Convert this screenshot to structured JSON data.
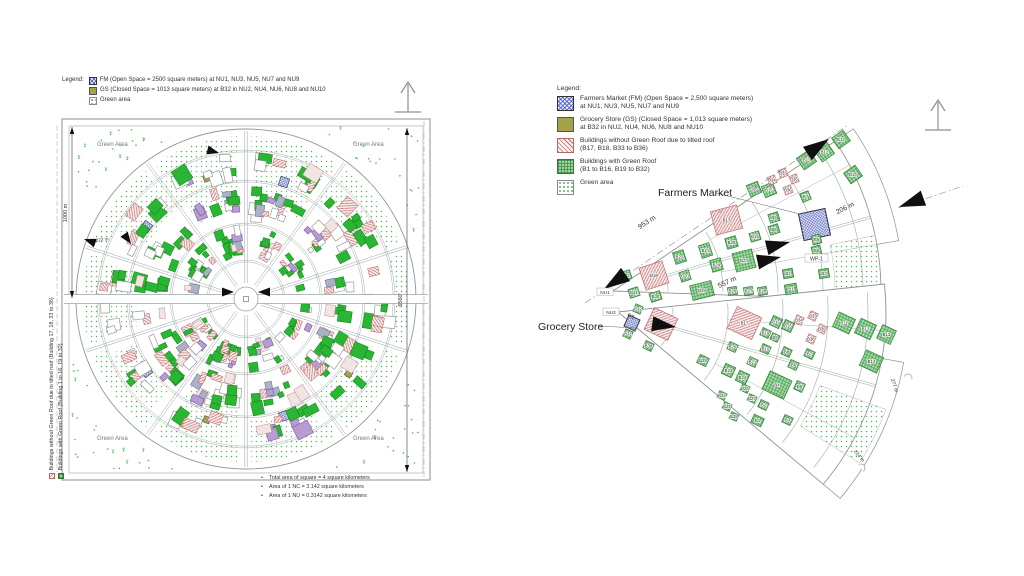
{
  "colors": {
    "road": "#9aa3a3",
    "frame": "#8f8f8f",
    "text": "#3c3c3c",
    "green_roof_fill": "#2ab535",
    "green_grid_fill": "#a9dcab",
    "green_grid_line": "#2e8b3a",
    "no_green_fill": "#f8ecec",
    "no_green_line": "#bf6868",
    "fm_fill": "#eef0fb",
    "fm_line": "#5f6dbf",
    "gs_fill": "#a6a24c",
    "purple_fill": "#b79bd4",
    "slate_fill": "#aab1c9",
    "green_dot": "#55b45c",
    "arrow_black": "#101010",
    "dim_line": "#9a9a9a"
  },
  "left_diagram": {
    "legend_title": "Legend:",
    "legend_items": [
      {
        "swatch": "fm",
        "label": "FM (Open Space = 2500 square meters) at NU1, NU3, NU5, NU7 and NU9"
      },
      {
        "swatch": "gs",
        "label": "GS (Closed Space = 1013 square meters) at B32 in NU2, NU4, NU6, NU8 and NU10"
      },
      {
        "swatch": "green-dots",
        "label": "Green area"
      }
    ],
    "side_legend_items": [
      {
        "swatch": "no-green-roof",
        "label": "Buildings without Green Roof due to tilted roof (Building 17, 18, 33 to 36)"
      },
      {
        "swatch": "green-roof",
        "label": "Buildings with Green Roof (Building 1 to 16, 19 to 32)"
      }
    ],
    "corner_label": "Green Area",
    "dim_left": "1000 m",
    "dim_right": "6560'",
    "dim_inner": "222 m",
    "notes": [
      "Total area of square = 4 square kilometers",
      "Area of 1 NC = 3.142 square kilometers",
      "Area of 1 NU = 0.3142 square kilometers"
    ]
  },
  "right_diagram": {
    "legend_title": "Legend:",
    "legend_items": [
      {
        "swatch": "fm",
        "lines": [
          "Farmers Market (FM) (Open Space = 2,500 square meters)",
          "at NU1, NU3, NU5, NU7 and NU9"
        ]
      },
      {
        "swatch": "gs",
        "lines": [
          "Grocery Store (GS) (Closed Space = 1,013 square meters)",
          "at B32 in NU2, NU4, NU6, NU8 and NU10"
        ]
      },
      {
        "swatch": "no-green-roof",
        "lines": [
          "Buildings without Green Roof due to tilted roof",
          "(B17, B18, B33 to B36)"
        ]
      },
      {
        "swatch": "green-roof",
        "lines": [
          "Buildings with Green Roof",
          "(B1 to B16, B19 to B32)"
        ]
      },
      {
        "swatch": "green-dots",
        "lines": [
          "Green area"
        ]
      }
    ],
    "callout_farmers_market": "Farmers Market",
    "callout_grocery_store": "Grocery Store",
    "label_wp1": "WP-1",
    "label_nu1": "NU1",
    "label_nu2": "NU2",
    "label_gs": "GS",
    "dimensions": [
      {
        "text": "953 m",
        "x": 648,
        "y": 224,
        "rot": -33,
        "fs": 7
      },
      {
        "text": "206 m",
        "x": 846,
        "y": 210,
        "rot": -27,
        "fs": 7
      },
      {
        "text": "557 m",
        "x": 728,
        "y": 284,
        "rot": -25,
        "fs": 7
      },
      {
        "text": "277 m",
        "x": 893,
        "y": 386,
        "rot": 72,
        "fs": 5
      },
      {
        "text": "224 m",
        "x": 858,
        "y": 457,
        "rot": 50,
        "fs": 5
      }
    ],
    "buildings": [
      {
        "label": "",
        "type": "fm",
        "x": 801,
        "y": 211,
        "w": 27,
        "h": 27,
        "rot": -12
      },
      {
        "label": "B17",
        "type": "ng",
        "x": 713,
        "y": 208,
        "w": 27,
        "h": 24,
        "rot": -15
      },
      {
        "label": "B18",
        "type": "ng",
        "x": 642,
        "y": 264,
        "w": 24,
        "h": 23,
        "rot": -18
      },
      {
        "label": "B32",
        "type": "g",
        "x": 621,
        "y": 271,
        "w": 10,
        "h": 9,
        "rot": -18
      },
      {
        "label": "B31",
        "type": "g",
        "x": 629,
        "y": 288,
        "w": 10,
        "h": 9,
        "rot": -18
      },
      {
        "label": "B30",
        "type": "g",
        "x": 650,
        "y": 292,
        "w": 11,
        "h": 9,
        "rot": -18
      },
      {
        "label": "B22",
        "type": "g",
        "x": 674,
        "y": 251,
        "w": 11,
        "h": 12,
        "rot": -18
      },
      {
        "label": "B20",
        "type": "g",
        "x": 680,
        "y": 271,
        "w": 10,
        "h": 10,
        "rot": -18
      },
      {
        "label": "B21",
        "type": "g",
        "x": 700,
        "y": 244,
        "w": 11,
        "h": 13,
        "rot": -18
      },
      {
        "label": "B29",
        "type": "g",
        "x": 691,
        "y": 283,
        "w": 22,
        "h": 15,
        "rot": -14
      },
      {
        "label": "B25",
        "type": "g",
        "x": 726,
        "y": 237,
        "w": 11,
        "h": 11,
        "rot": -16
      },
      {
        "label": "B24",
        "type": "g",
        "x": 711,
        "y": 259,
        "w": 11,
        "h": 12,
        "rot": -16
      },
      {
        "label": "B23",
        "type": "g",
        "x": 734,
        "y": 251,
        "w": 20,
        "h": 19,
        "rot": -14
      },
      {
        "label": "B26",
        "type": "g",
        "x": 728,
        "y": 287,
        "w": 9,
        "h": 8,
        "rot": -10
      },
      {
        "label": "B27",
        "type": "g",
        "x": 744,
        "y": 287,
        "w": 9,
        "h": 8,
        "rot": -10
      },
      {
        "label": "B28",
        "type": "g",
        "x": 758,
        "y": 287,
        "w": 9,
        "h": 8,
        "rot": -10
      },
      {
        "label": "B19",
        "type": "g",
        "x": 750,
        "y": 232,
        "w": 10,
        "h": 9,
        "rot": -16
      },
      {
        "label": "B16",
        "type": "g",
        "x": 748,
        "y": 183,
        "w": 12,
        "h": 12,
        "rot": -22
      },
      {
        "label": "B15",
        "type": "g",
        "x": 763,
        "y": 184,
        "w": 12,
        "h": 12,
        "rot": -22
      },
      {
        "label": "B34",
        "type": "ng",
        "x": 768,
        "y": 176,
        "w": 8,
        "h": 8,
        "rot": -22
      },
      {
        "label": "B33",
        "type": "ng",
        "x": 779,
        "y": 169,
        "w": 8,
        "h": 8,
        "rot": -22
      },
      {
        "label": "B35",
        "type": "ng",
        "x": 790,
        "y": 175,
        "w": 8,
        "h": 8,
        "rot": -22
      },
      {
        "label": "B36",
        "type": "ng",
        "x": 784,
        "y": 186,
        "w": 8,
        "h": 8,
        "rot": -22
      },
      {
        "label": "B7",
        "type": "g",
        "x": 801,
        "y": 192,
        "w": 9,
        "h": 9,
        "rot": -22
      },
      {
        "label": "B9",
        "type": "g",
        "x": 769,
        "y": 213,
        "w": 10,
        "h": 9,
        "rot": -18
      },
      {
        "label": "B8",
        "type": "g",
        "x": 769,
        "y": 225,
        "w": 10,
        "h": 9,
        "rot": -18
      },
      {
        "label": "B5",
        "type": "g",
        "x": 812,
        "y": 235,
        "w": 9,
        "h": 9,
        "rot": -14
      },
      {
        "label": "B6",
        "type": "g",
        "x": 812,
        "y": 246,
        "w": 9,
        "h": 9,
        "rot": -14
      },
      {
        "label": "B2",
        "type": "g",
        "x": 783,
        "y": 269,
        "w": 10,
        "h": 9,
        "rot": -10
      },
      {
        "label": "B1",
        "type": "g",
        "x": 785,
        "y": 284,
        "w": 12,
        "h": 10,
        "rot": -10
      },
      {
        "label": "B3",
        "type": "g",
        "x": 819,
        "y": 269,
        "w": 10,
        "h": 9,
        "rot": -10
      },
      {
        "label": "B11",
        "type": "g",
        "x": 799,
        "y": 153,
        "w": 15,
        "h": 14,
        "rot": -35
      },
      {
        "label": "B12",
        "type": "g",
        "x": 817,
        "y": 145,
        "w": 15,
        "h": 14,
        "rot": -35
      },
      {
        "label": "B13",
        "type": "g",
        "x": 834,
        "y": 133,
        "w": 14,
        "h": 13,
        "rot": -35
      },
      {
        "label": "B14",
        "type": "g",
        "x": 846,
        "y": 168,
        "w": 14,
        "h": 13,
        "rot": -35
      },
      {
        "label": "B32",
        "type": "g",
        "x": 634,
        "y": 305,
        "w": 8,
        "h": 8,
        "rot": 25
      },
      {
        "label": "",
        "type": "fm",
        "x": 626,
        "y": 317,
        "w": 12,
        "h": 12,
        "rot": 25
      },
      {
        "label": "B18",
        "type": "ng",
        "x": 648,
        "y": 312,
        "w": 26,
        "h": 24,
        "rot": 25
      },
      {
        "label": "B31",
        "type": "g",
        "x": 624,
        "y": 330,
        "w": 8,
        "h": 8,
        "rot": 25
      },
      {
        "label": "B30",
        "type": "g",
        "x": 644,
        "y": 342,
        "w": 9,
        "h": 8,
        "rot": 25
      },
      {
        "label": "B17",
        "type": "ng",
        "x": 731,
        "y": 311,
        "w": 27,
        "h": 24,
        "rot": 25
      },
      {
        "label": "B19",
        "type": "g",
        "x": 761,
        "y": 329,
        "w": 9,
        "h": 8,
        "rot": 25
      },
      {
        "label": "B16",
        "type": "g",
        "x": 771,
        "y": 317,
        "w": 10,
        "h": 10,
        "rot": 25
      },
      {
        "label": "B15",
        "type": "g",
        "x": 783,
        "y": 321,
        "w": 10,
        "h": 10,
        "rot": 25
      },
      {
        "label": "B34",
        "type": "ng",
        "x": 795,
        "y": 316,
        "w": 8,
        "h": 8,
        "rot": 25
      },
      {
        "label": "B33",
        "type": "ng",
        "x": 809,
        "y": 312,
        "w": 8,
        "h": 8,
        "rot": 25
      },
      {
        "label": "B35",
        "type": "ng",
        "x": 818,
        "y": 325,
        "w": 8,
        "h": 8,
        "rot": 25
      },
      {
        "label": "B36",
        "type": "ng",
        "x": 807,
        "y": 335,
        "w": 8,
        "h": 8,
        "rot": 25
      },
      {
        "label": "B11",
        "type": "g",
        "x": 835,
        "y": 315,
        "w": 18,
        "h": 16,
        "rot": 25
      },
      {
        "label": "B12",
        "type": "g",
        "x": 857,
        "y": 321,
        "w": 17,
        "h": 16,
        "rot": 25
      },
      {
        "label": "B13",
        "type": "g",
        "x": 879,
        "y": 327,
        "w": 15,
        "h": 15,
        "rot": 25
      },
      {
        "label": "B14",
        "type": "g",
        "x": 862,
        "y": 353,
        "w": 19,
        "h": 17,
        "rot": 25
      },
      {
        "label": "B20",
        "type": "g",
        "x": 728,
        "y": 343,
        "w": 9,
        "h": 8,
        "rot": 25
      },
      {
        "label": "B10",
        "type": "g",
        "x": 761,
        "y": 345,
        "w": 9,
        "h": 8,
        "rot": 25
      },
      {
        "label": "B9",
        "type": "g",
        "x": 771,
        "y": 334,
        "w": 8,
        "h": 7,
        "rot": 25
      },
      {
        "label": "B8",
        "type": "g",
        "x": 782,
        "y": 348,
        "w": 9,
        "h": 8,
        "rot": 25
      },
      {
        "label": "B7",
        "type": "g",
        "x": 805,
        "y": 350,
        "w": 9,
        "h": 8,
        "rot": 25
      },
      {
        "label": "B6",
        "type": "g",
        "x": 789,
        "y": 361,
        "w": 9,
        "h": 8,
        "rot": 25
      },
      {
        "label": "B29",
        "type": "g",
        "x": 698,
        "y": 356,
        "w": 10,
        "h": 9,
        "rot": 25
      },
      {
        "label": "B23",
        "type": "g",
        "x": 723,
        "y": 365,
        "w": 11,
        "h": 11,
        "rot": 25
      },
      {
        "label": "B24",
        "type": "g",
        "x": 737,
        "y": 372,
        "w": 11,
        "h": 11,
        "rot": 25
      },
      {
        "label": "B21",
        "type": "g",
        "x": 748,
        "y": 358,
        "w": 9,
        "h": 8,
        "rot": 25
      },
      {
        "label": "B4",
        "type": "g",
        "x": 765,
        "y": 375,
        "w": 24,
        "h": 20,
        "rot": 25
      },
      {
        "label": "B5",
        "type": "g",
        "x": 795,
        "y": 382,
        "w": 9,
        "h": 9,
        "rot": 25
      },
      {
        "label": "B2",
        "type": "g",
        "x": 759,
        "y": 401,
        "w": 9,
        "h": 8,
        "rot": 25
      },
      {
        "label": "B1",
        "type": "g",
        "x": 752,
        "y": 416,
        "w": 11,
        "h": 9,
        "rot": 25
      },
      {
        "label": "B3",
        "type": "g",
        "x": 783,
        "y": 416,
        "w": 9,
        "h": 8,
        "rot": 25
      },
      {
        "label": "B22",
        "type": "g",
        "x": 718,
        "y": 392,
        "w": 8,
        "h": 7,
        "rot": 25
      },
      {
        "label": "B25",
        "type": "g",
        "x": 723,
        "y": 403,
        "w": 8,
        "h": 7,
        "rot": 25
      },
      {
        "label": "B28",
        "type": "g",
        "x": 730,
        "y": 413,
        "w": 8,
        "h": 7,
        "rot": 25
      },
      {
        "label": "B26",
        "type": "g",
        "x": 741,
        "y": 385,
        "w": 8,
        "h": 7,
        "rot": 25
      },
      {
        "label": "B27",
        "type": "g",
        "x": 748,
        "y": 395,
        "w": 8,
        "h": 7,
        "rot": 25
      }
    ]
  }
}
